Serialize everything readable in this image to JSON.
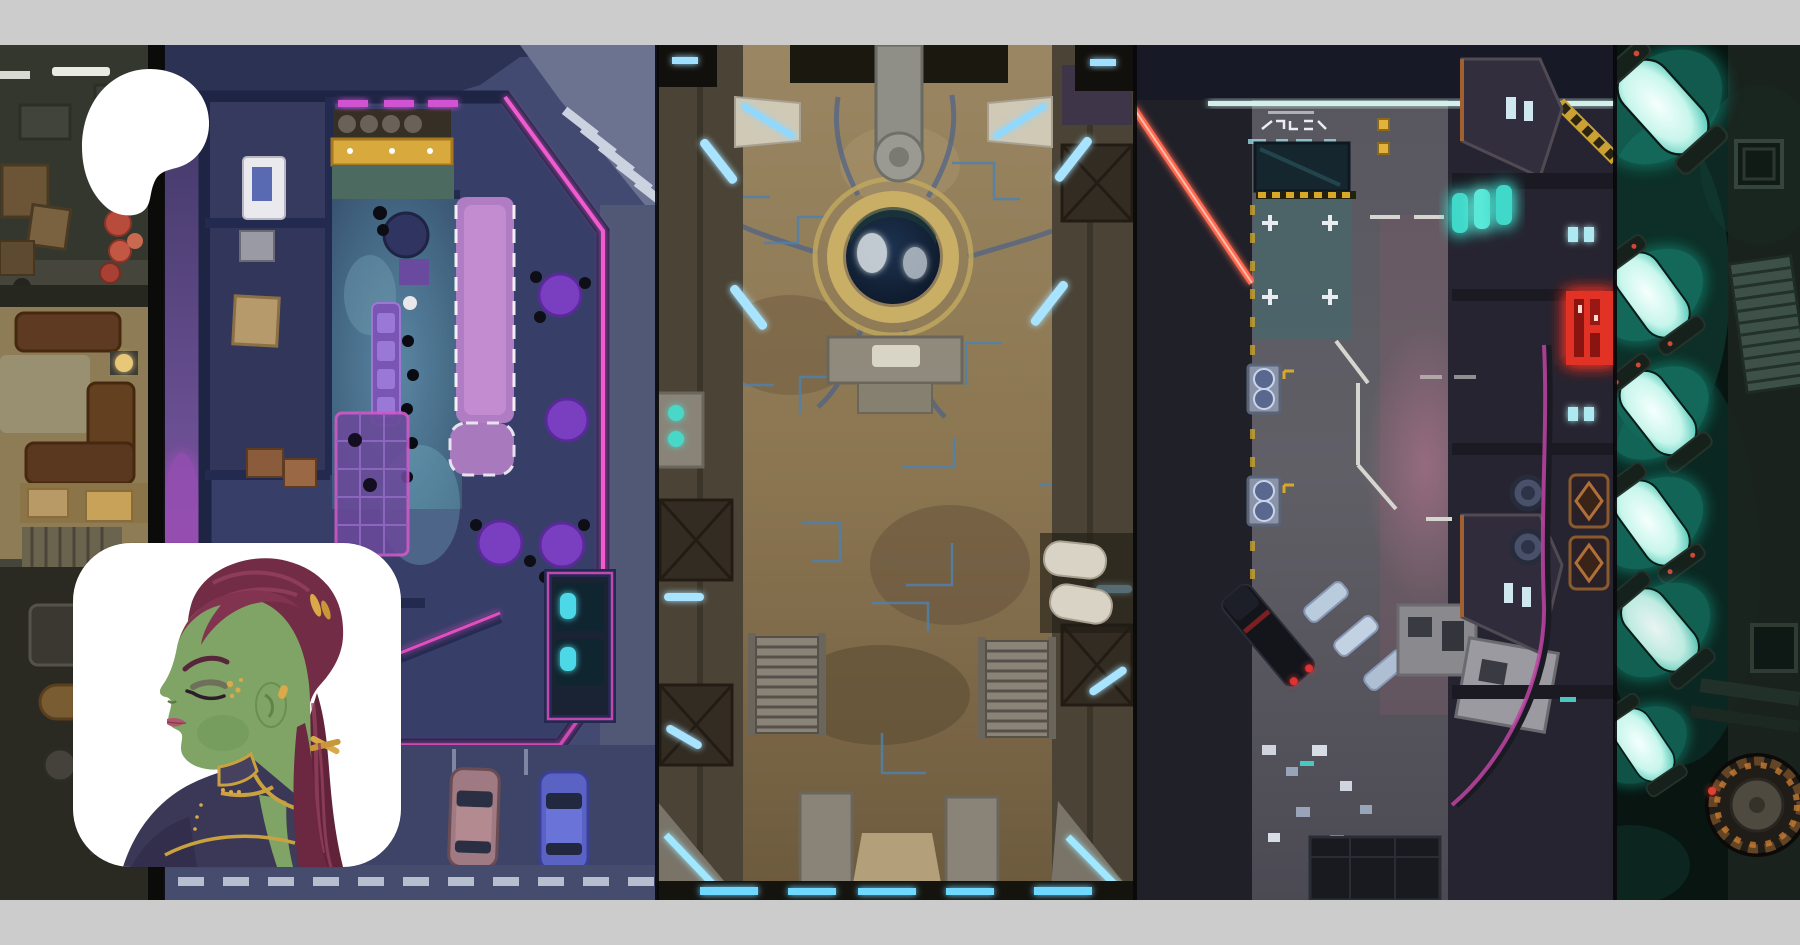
{
  "page": {
    "background_color": "#cccccc"
  },
  "brand": {
    "logo": "patreon-logo",
    "logo_color": "#ffffff"
  },
  "banner": {
    "description": "cover collage of five top-down sci-fi battlemaps",
    "panels": [
      {
        "id": "industrial-quarters-map",
        "base_color": "#45453c"
      },
      {
        "id": "neon-nightclub-map",
        "base_color": "#424a72"
      },
      {
        "id": "temple-plaza-map",
        "base_color": "#94805c"
      },
      {
        "id": "street-depot-map",
        "base_color": "#36363e"
      },
      {
        "id": "reactor-vats-map",
        "base_color": "#081511"
      }
    ],
    "accent_colors": {
      "neon_pink": "#f055cc",
      "neon_cyan": "#9fe0ff",
      "neon_teal": "#2ad8c0",
      "neon_red": "#ff6a50",
      "sign_red": "#e23028",
      "gold": "#c9a84e"
    }
  },
  "avatar": {
    "id": "creator-avatar",
    "background_color": "#ffffff",
    "subject": "green-skinned woman with dark red ponytail in purple uniform"
  }
}
